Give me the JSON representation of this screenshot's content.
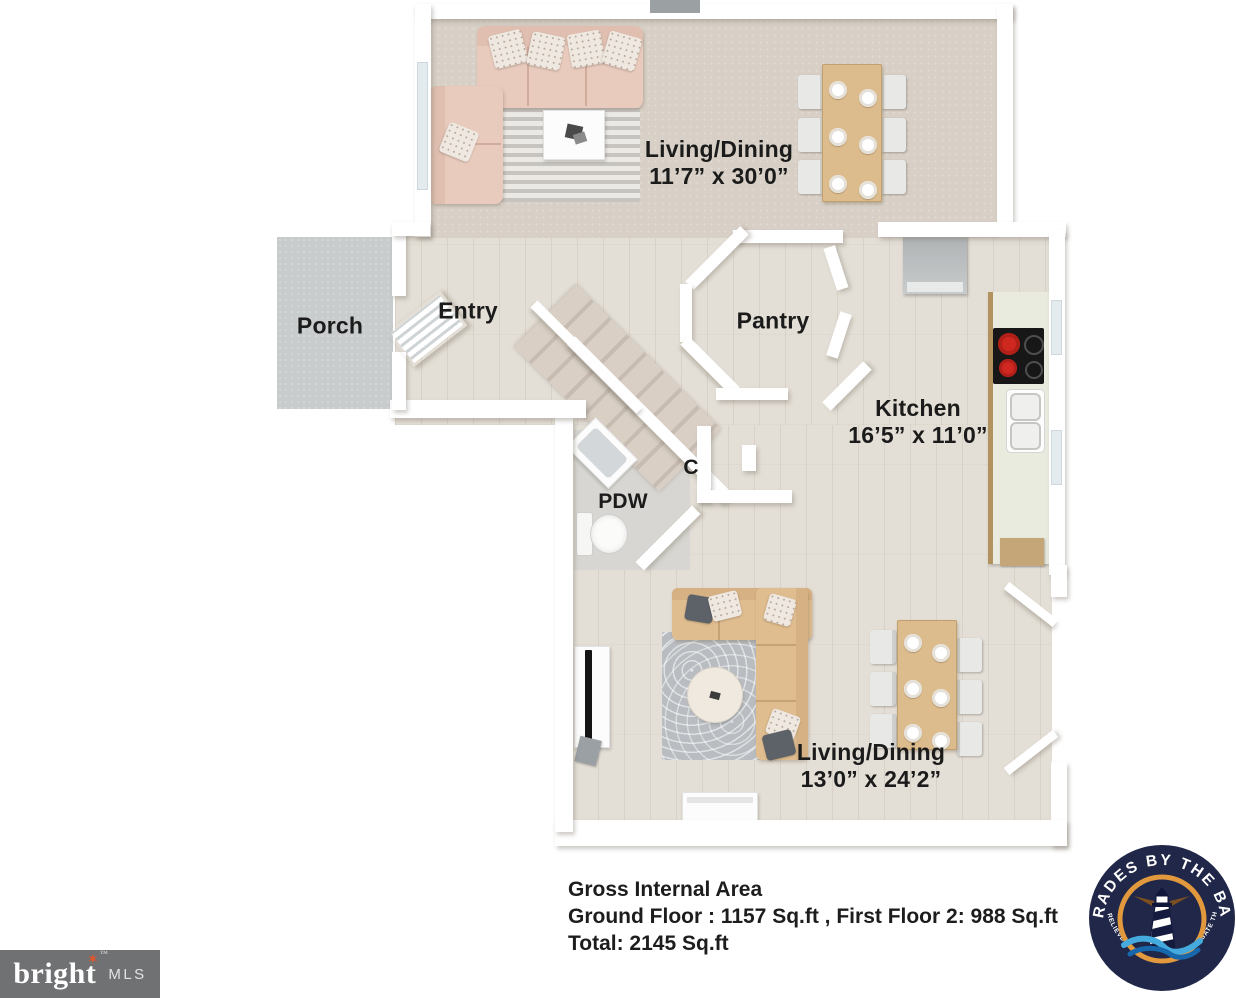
{
  "rooms": {
    "living_dining_upper": {
      "name": "Living/Dining",
      "dims": "11’7” x 30’0”"
    },
    "porch": {
      "name": "Porch"
    },
    "entry": {
      "name": "Entry"
    },
    "pantry": {
      "name": "Pantry"
    },
    "kitchen": {
      "name": "Kitchen",
      "dims": "16’5” x 11’0”"
    },
    "powder_room": {
      "name": "PDW"
    },
    "closet": {
      "name": "C"
    },
    "living_dining_lower": {
      "name": "Living/Dining",
      "dims": "13’0” x 24’2”"
    }
  },
  "area_summary": {
    "title": "Gross Internal Area",
    "floors_line": "Ground Floor  : 1157 Sq.ft , First Floor 2: 988 Sq.ft",
    "total_line": "Total: 2145 Sq.ft"
  },
  "logos": {
    "bright_mls": {
      "brand": "bright",
      "star": "✶",
      "trademark": "™",
      "suffix": "MLS",
      "background": "#707173",
      "star_color": "#e1572c"
    },
    "trades_by_the_bay": {
      "arc_top": "TRADES BY THE BAY",
      "arc_bottom": "LET US RELIEVE THE STRESS AND NAVIGATE THE REST",
      "navy": "#202748",
      "orange": "#e2993e",
      "wave_light": "#45aadd",
      "wave_dark": "#1767ad"
    }
  },
  "palette": {
    "carpet": "#d8d0c6",
    "wood": "#e4dfd6",
    "porch": "#c8cccc",
    "wall": "#ffffff",
    "label": "#1b1b1b"
  }
}
